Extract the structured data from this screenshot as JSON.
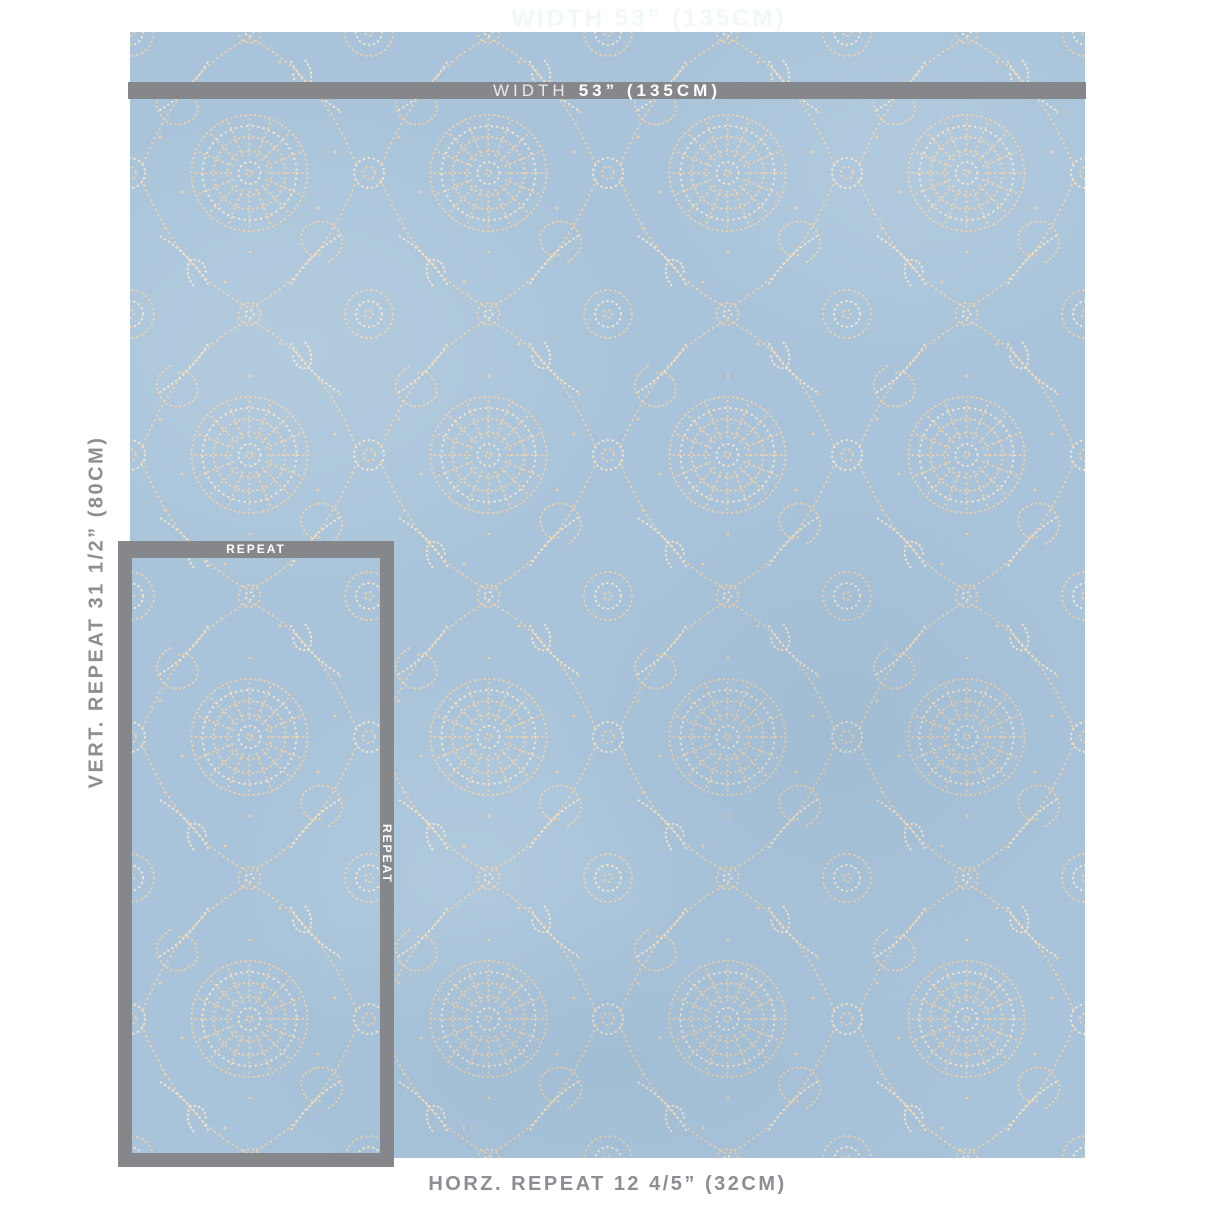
{
  "labels": {
    "watermark": "WIDTH 53” (135CM)",
    "width_prefix": "WIDTH",
    "width_value": "53” (135CM)",
    "vertical_repeat": "VERT. REPEAT 31 1/2” (80CM)",
    "horizontal_repeat": "HORZ. REPEAT 12 4/5” (32CM)",
    "repeat_top": "REPEAT",
    "repeat_side": "REPEAT"
  },
  "measurements": {
    "width": {
      "inches": "53”",
      "cm": "135CM"
    },
    "vertical_repeat": {
      "inches": "31 1/2”",
      "cm": "80CM"
    },
    "horizontal_repeat": {
      "inches": "12 4/5”",
      "cm": "32CM"
    }
  },
  "swatch": {
    "description": "light blue fabric with allover cream dotted embroidery of medallions, paisleys and floral sprigs",
    "ground_color": "#a9c4da",
    "embroidery_color": "#e8ceac",
    "embroidery_highlight": "#f2e1c8"
  },
  "ui_colors": {
    "bar_gray": "#85878a",
    "label_gray": "#8b8e93",
    "bar_text": "#ffffff",
    "watermark": "#f1f8f8",
    "background": "#ffffff"
  }
}
